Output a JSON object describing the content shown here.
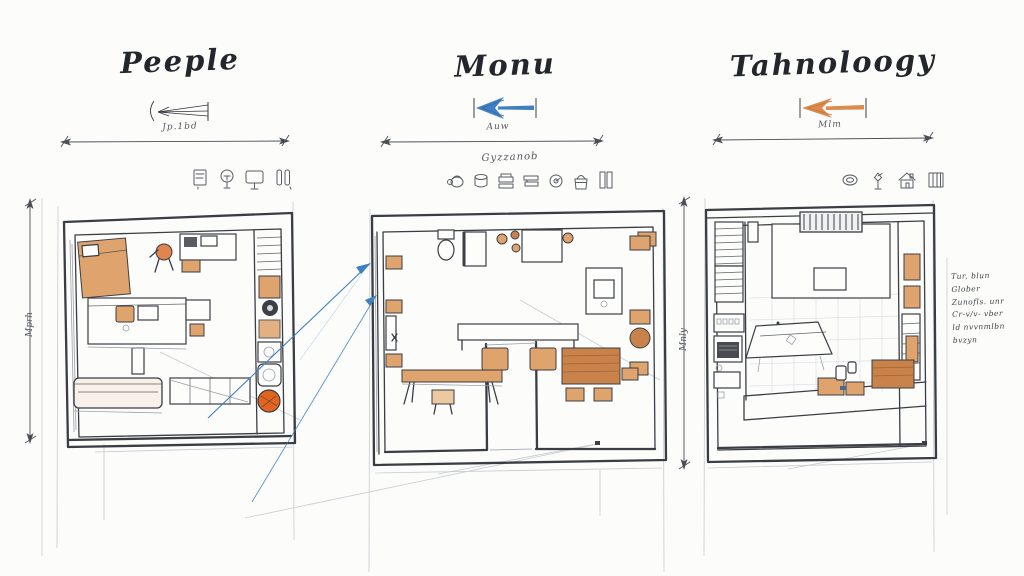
{
  "colors": {
    "paper": "#fcfcfb",
    "ink": "#3a3e44",
    "pencil": "#9aa0a8",
    "wood": "#dfa36d",
    "wood-dark": "#c9834a",
    "accent": "#e2641f",
    "blue": "#3f7fc2",
    "orange-arrow": "#dd8a4e"
  },
  "panels": [
    {
      "title": "Peeple",
      "dim_label": "Jp.1bd",
      "side_label": "Mprh",
      "arrow_color": "#33373c",
      "icons": [
        "appliance-icon",
        "lamp-icon",
        "monitor-icon",
        "door-icon"
      ]
    },
    {
      "title": "Monu",
      "dim_label": "Auw",
      "icons_label": "Gyzzanob",
      "side_label": "Mnly",
      "arrow_color": "#3f7fc2",
      "icons": [
        "kettle-icon",
        "cup-icon",
        "tray-icon",
        "books-icon",
        "clock-icon",
        "basket-icon",
        "window-icon"
      ]
    },
    {
      "title": "Tahnoloogy",
      "dim_label": "Mlm",
      "arrow_color": "#dd8a4e",
      "icons": [
        "plate-icon",
        "plant-icon",
        "house-icon",
        "grid-icon"
      ],
      "notes": [
        "Tur, blun Glober",
        "Zunofls. unr",
        "Cr-v/v- vber",
        "ld nvvnmlbn",
        "bvzyn"
      ]
    }
  ]
}
